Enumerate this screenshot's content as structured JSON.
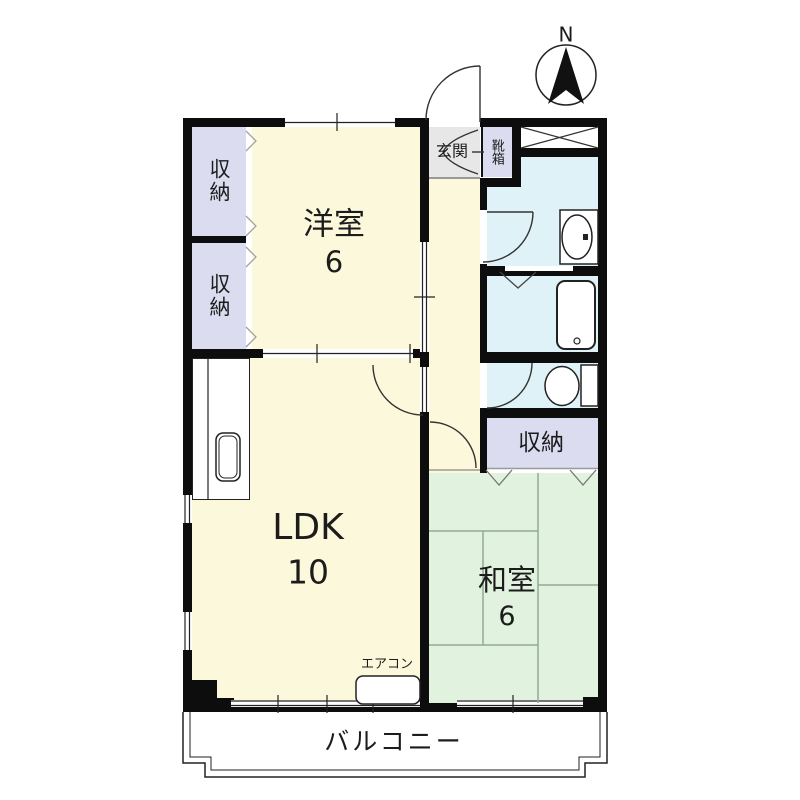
{
  "plan": {
    "type": "apartment-floor-plan",
    "compass": {
      "north_label": "N"
    },
    "labels": {
      "north": "N",
      "western_room": "洋室",
      "western_room_size": "6",
      "closet_top": "収納",
      "closet_bottom": "収納",
      "hall_closet": "収納",
      "entrance": "玄関",
      "shoe_box": "靴箱",
      "ldk": "LDK",
      "ldk_size": "10",
      "japanese_room": "和室",
      "japanese_room_size": "6",
      "aircon": "エアコン",
      "balcony": "バルコニー"
    },
    "colors": {
      "wall": "#0d0d0d",
      "western_room_fill": "#fcf8db",
      "ldk_fill": "#fcf8db",
      "japanese_room_fill": "#e1f3df",
      "closet_fill": "#dbdcf0",
      "entrance_fill": "#e7e7e7",
      "wet_area_fill": "#dff2f7",
      "balcony_fill": "#ffffff",
      "tatami_line": "#90ab90"
    }
  }
}
